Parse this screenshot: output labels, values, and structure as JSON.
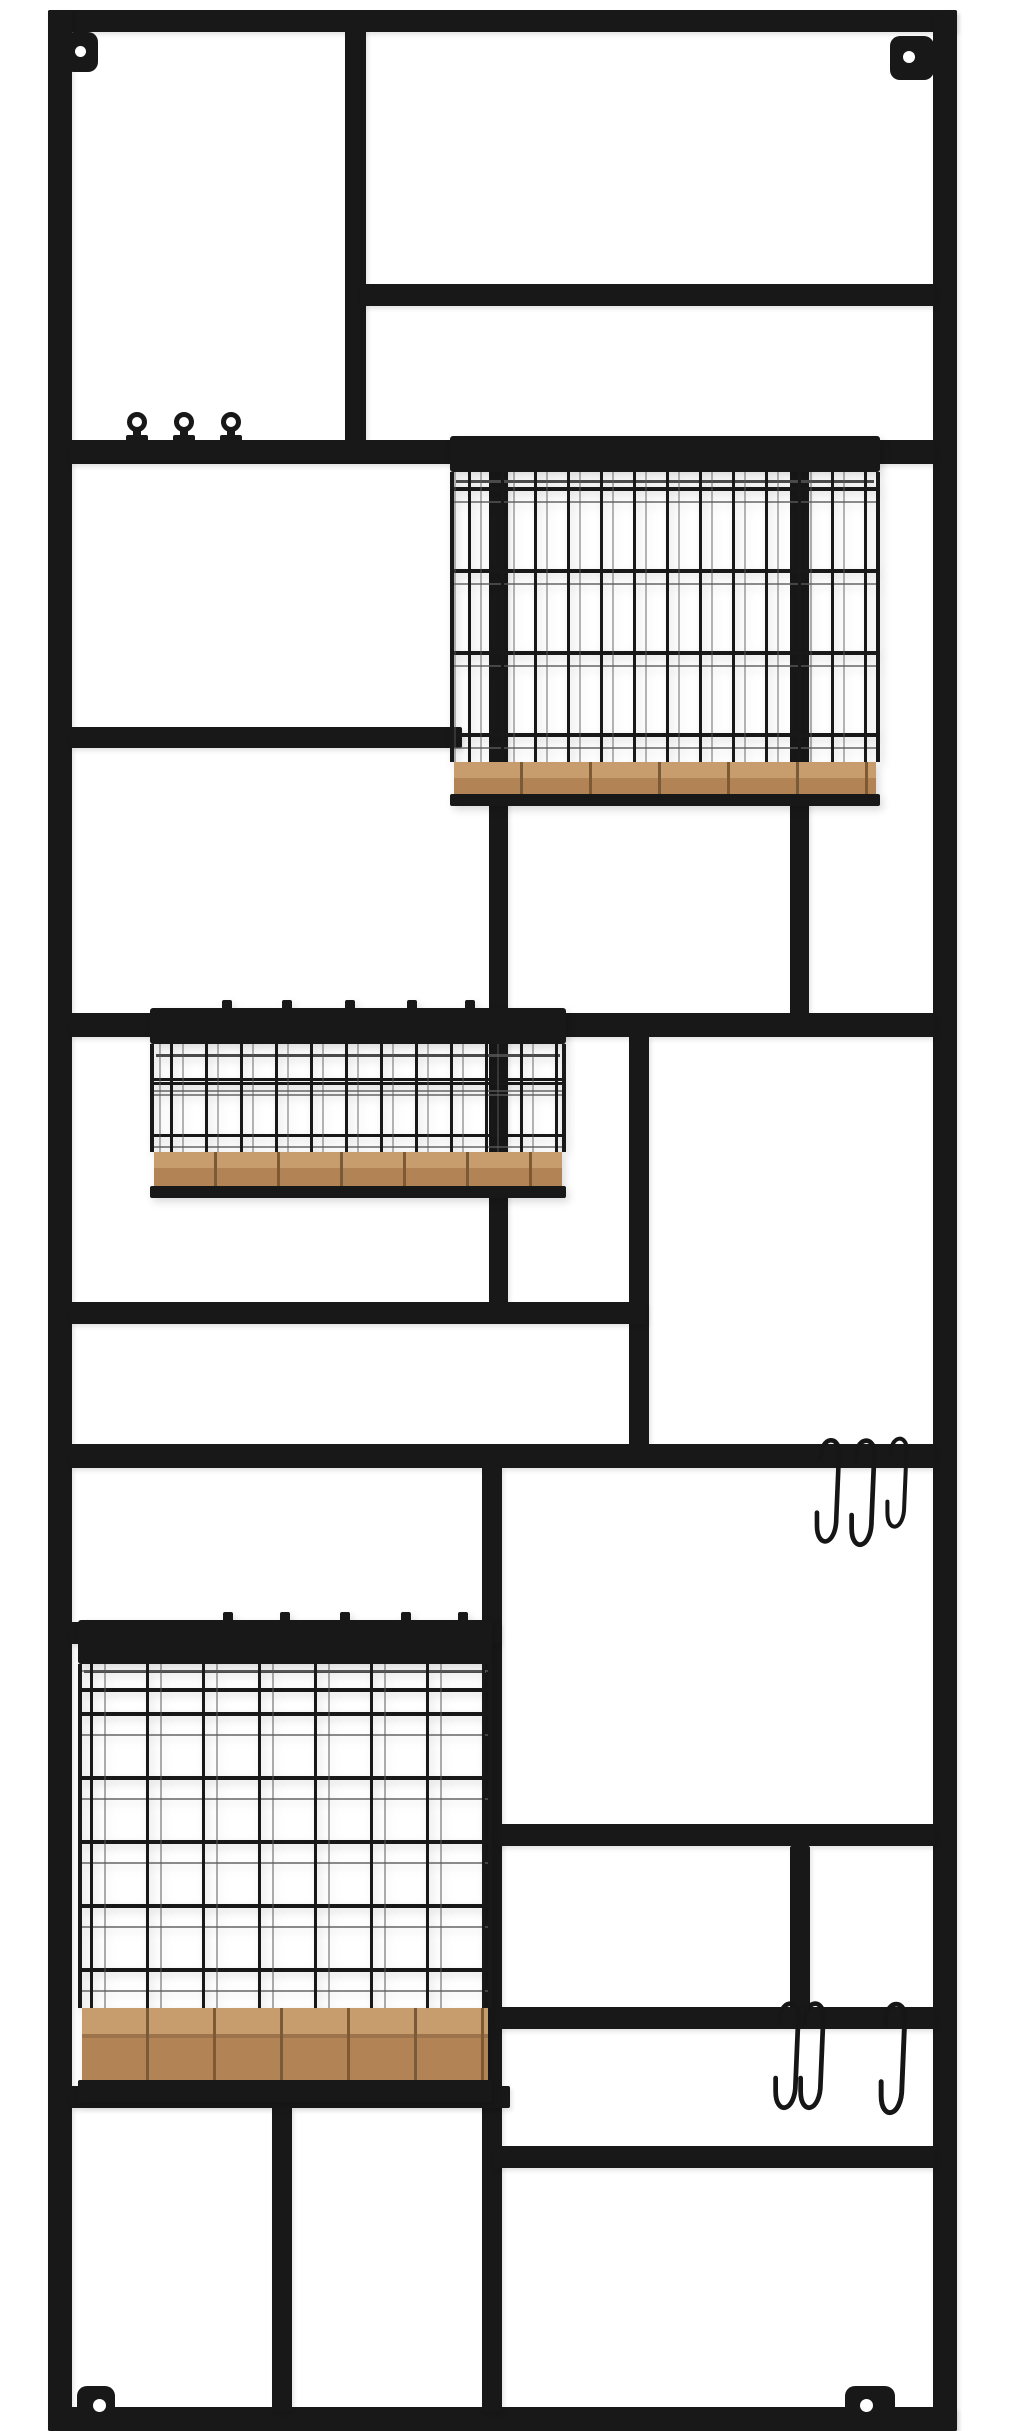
{
  "scene": {
    "description": "Black metal wall-mounted modular storage rack on a white background, built as a tall rectangular frame divided into rectangular cells by horizontal and vertical bars, holding three black wire baskets with natural wood bases, three ball knob hooks, five black S-hooks and four corner screw mounting tabs",
    "aria_label": "Wall rack with wire baskets and hooks"
  },
  "palette": {
    "metal": "#181818",
    "wire_echo": "#4a4a4a",
    "wood_top": "#c79d6e",
    "wood_front": "#b28354",
    "wood_seam": "#7d5a36",
    "background": "#ffffff",
    "hole": "#ffffff"
  },
  "objects": {
    "frame": {
      "label": "rectangular metal frame with internal divider bars",
      "color_name": "matte black"
    },
    "mounting_tabs": {
      "count": 4,
      "positions": [
        "top-left",
        "top-right",
        "bottom-left",
        "bottom-right"
      ]
    },
    "knob_hooks": {
      "count": 3,
      "position": "on upper-left horizontal bar"
    },
    "baskets": [
      {
        "label": "large square wire basket with wood base",
        "position": "upper right"
      },
      {
        "label": "shallow rectangular wire basket with wood base",
        "position": "middle left"
      },
      {
        "label": "tall wire basket with thick wood base",
        "position": "lower left"
      }
    ],
    "s_hooks": [
      {
        "count": 3,
        "position": "hanging on middle-right bar"
      },
      {
        "count": 3,
        "position": "hanging on lower-right bar"
      }
    ]
  }
}
